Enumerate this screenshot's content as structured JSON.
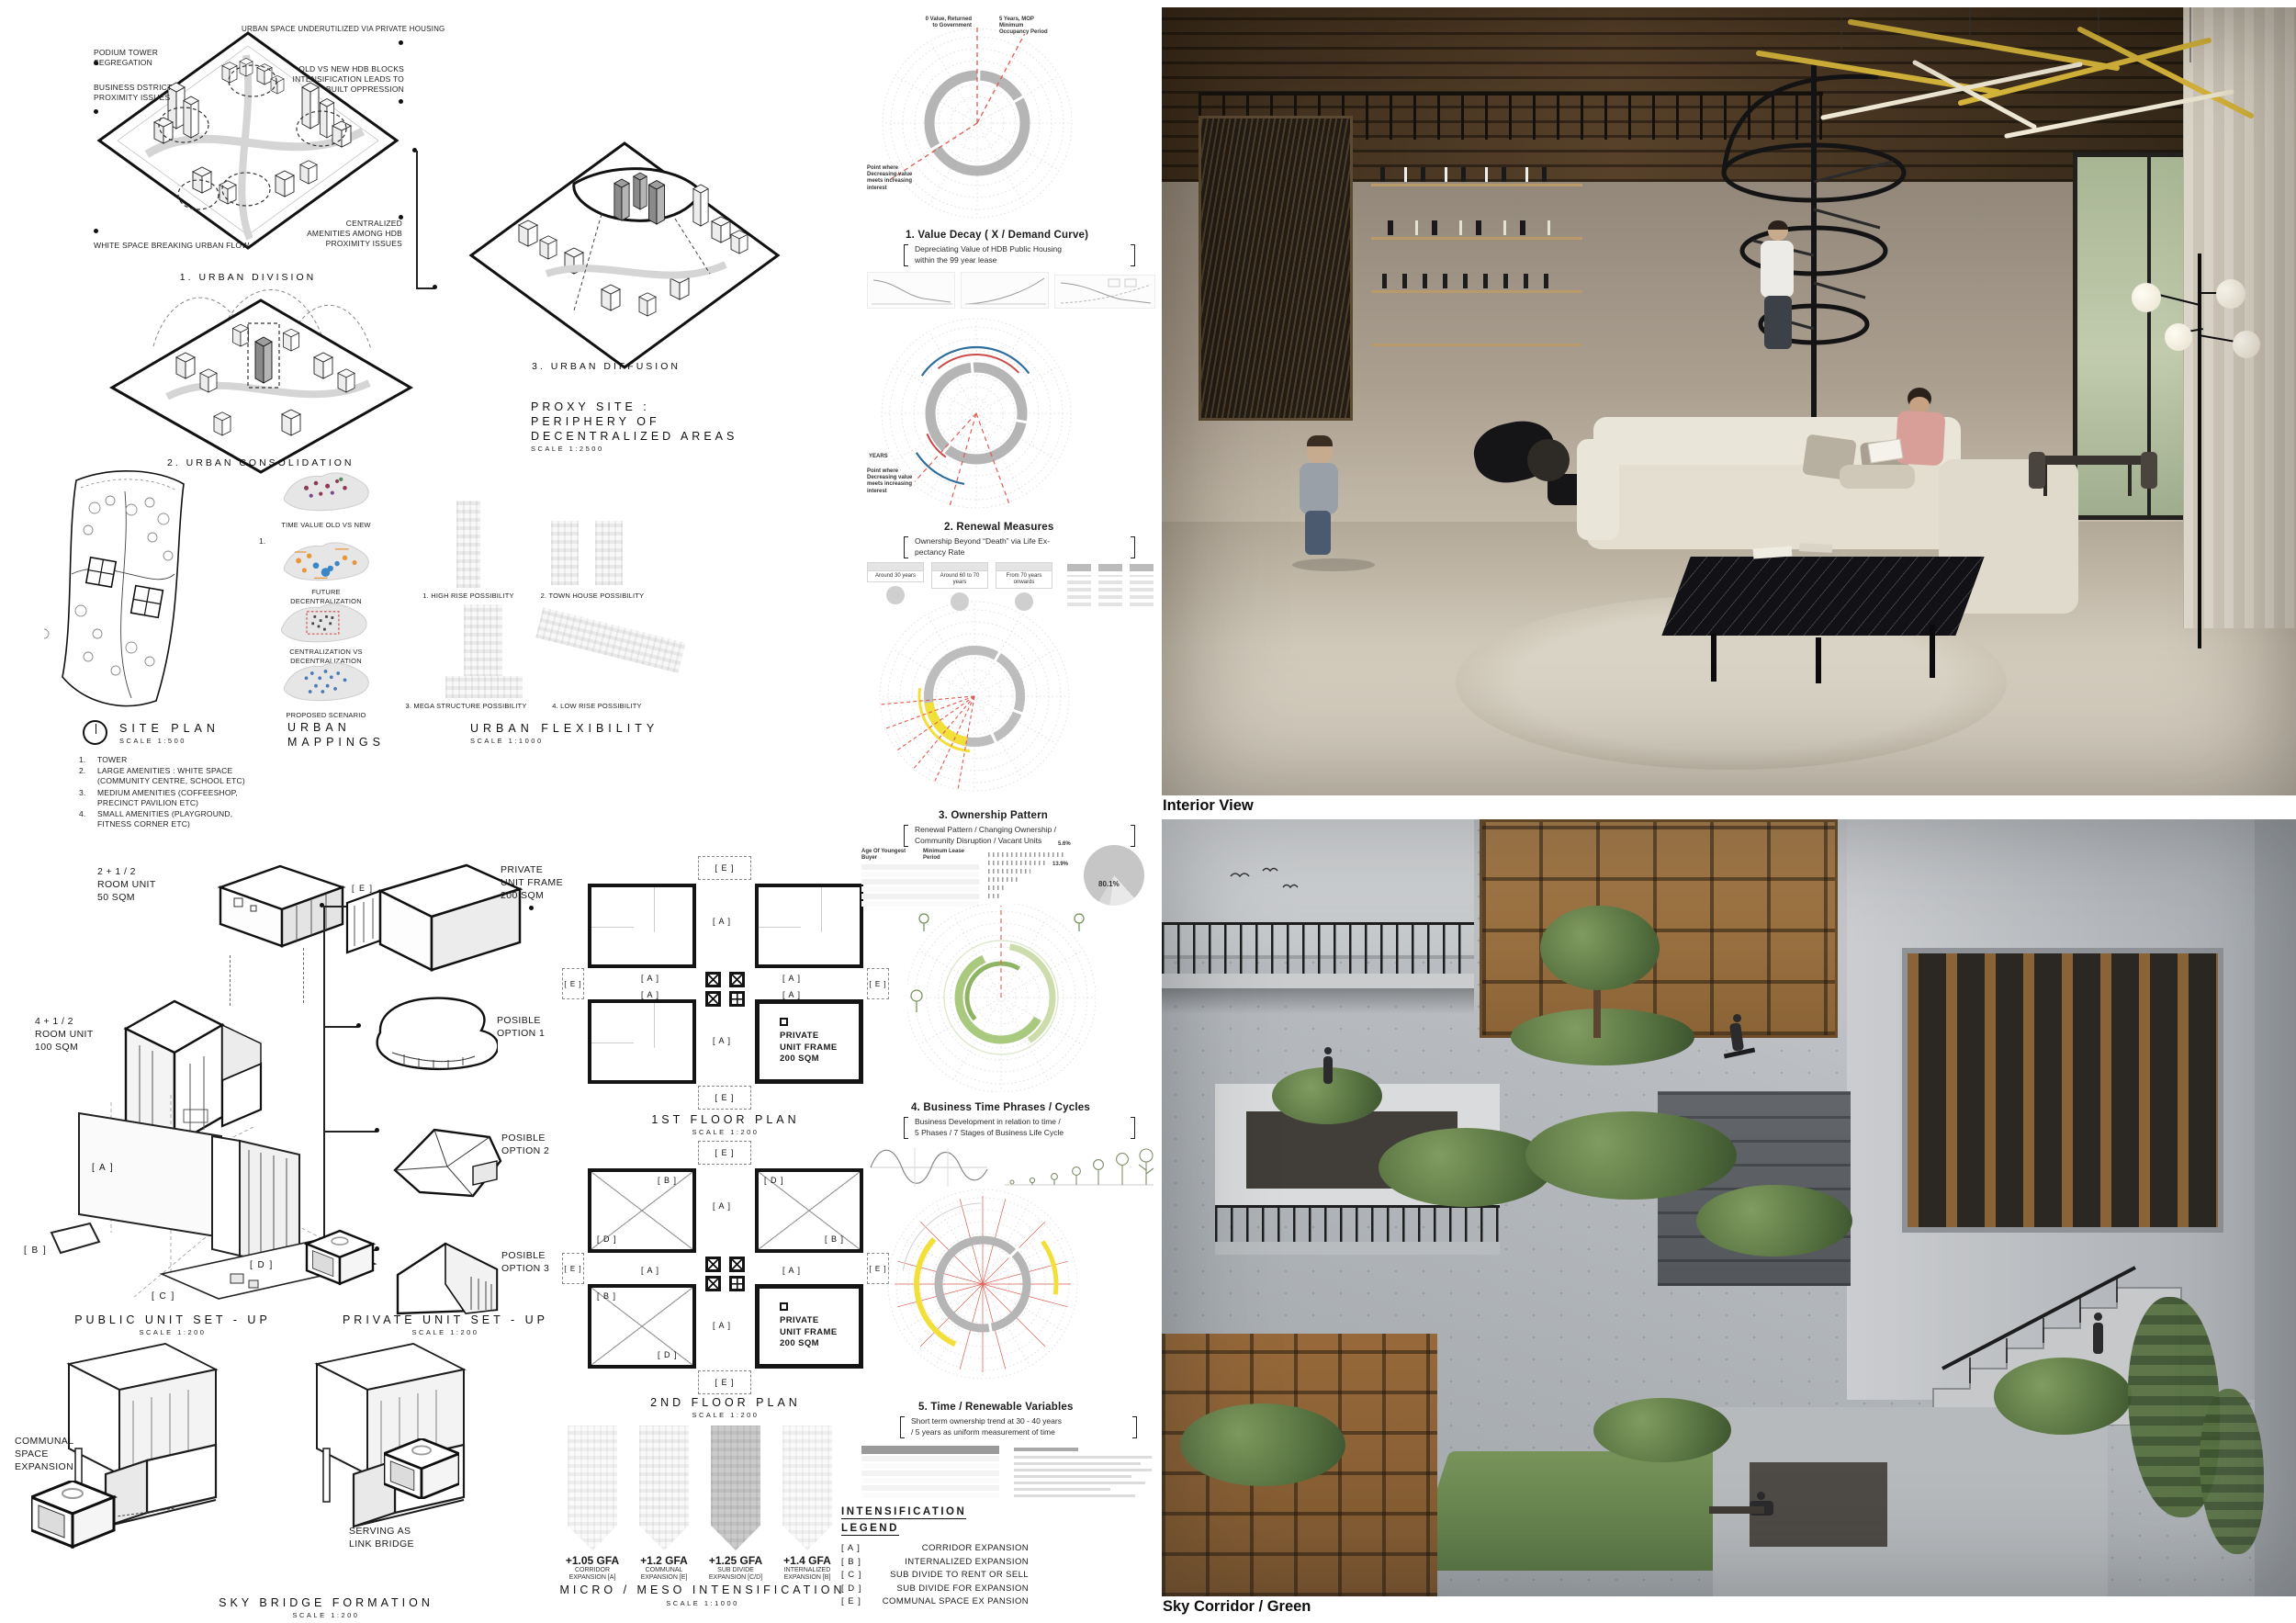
{
  "colors": {
    "ink": "#1a1a1a",
    "accent_red": "#e05b52",
    "accent_blue": "#2e6e9e",
    "accent_yellow": "#f3df3a",
    "accent_green": "#a9c97e",
    "ring_gray": "#b5b5b5"
  },
  "d1": {
    "label": "1. URBAN DIVISION",
    "c1": "URBAN SPACE UNDERUTILIZED VIA PRIVATE HOUSING",
    "c2": "PODIUM TOWER SEGREGATION",
    "c3": "BUSINESS DSTRICT PROXIMITY ISSUES",
    "c4": "OLD VS NEW HDB BLOCKS INTENSIFICATION LEADS TO BUILT OPPRESSION",
    "c5": "CENTRALIZED AMENITIES AMONG HDB PROXIMITY ISSUES",
    "c6": "WHITE SPACE BREAKING URBAN FLOW"
  },
  "d2": {
    "label": "2. URBAN CONSOLIDATION"
  },
  "d3": {
    "label": "3. URBAN DIFFUSION"
  },
  "proxy": {
    "l1": "PROXY SITE :",
    "l2": "PERIPHERY OF",
    "l3": "DECENTRALIZED AREAS",
    "scale": "SCALE 1:2500"
  },
  "site_plan": {
    "title": "SITE PLAN",
    "scale": "SCALE 1:500",
    "legend": [
      {
        "n": "1.",
        "t": "TOWER"
      },
      {
        "n": "2.",
        "t": "LARGE AMENITIES : WHITE SPACE (COMMUNITY CENTRE, SCHOOL ETC)"
      },
      {
        "n": "3.",
        "t": "MEDIUM AMENITIES (COFFEESHOP, PRECINCT PAVILION ETC)"
      },
      {
        "n": "4.",
        "t": "SMALL AMENITIES (PLAYGROUND, FITNESS CORNER ETC)"
      }
    ]
  },
  "mappings": {
    "t1": "URBAN",
    "t2": "MAPPINGS",
    "marker": "1.",
    "maps": [
      {
        "label": "TIME VALUE OLD VS NEW"
      },
      {
        "label": "FUTURE DECENTRALIZATION"
      },
      {
        "label": "CENTRALIZATION VS DECENTRALIZATION"
      },
      {
        "label": "PROPOSED SCENARIO"
      }
    ]
  },
  "flex": {
    "title": "URBAN FLEXIBILITY",
    "scale": "SCALE 1:1000",
    "o1": "1. HIGH RISE POSSIBILITY",
    "o2": "2. TOWN HOUSE POSSIBILITY",
    "o3": "3. MEGA STRUCTURE POSSIBILITY",
    "o4": "4. LOW RISE POSSIBILITY"
  },
  "units": {
    "small": {
      "l1": "2 + 1 / 2",
      "l2": "ROOM UNIT",
      "l3": "50 SQM"
    },
    "large": {
      "l1": "4 + 1 / 2",
      "l2": "ROOM UNIT",
      "l3": "100 SQM"
    },
    "frame": {
      "l1": "PRIVATE",
      "l2": "UNIT FRAME",
      "l3": "200 SQM"
    },
    "frame_tag": "[ E ]",
    "opt1a": "POSIBLE",
    "opt1b": "OPTION 1",
    "opt2a": "POSIBLE",
    "opt2b": "OPTION 2",
    "opt3a": "POSIBLE",
    "opt3b": "OPTION 3"
  },
  "setups": {
    "pub": "PUBLIC UNIT SET - UP",
    "priv": "PRIVATE UNIT SET - UP",
    "scale": "SCALE 1:200"
  },
  "tags": {
    "a": "[ A ]",
    "b": "[ B ]",
    "c": "[ C ]",
    "d": "[ D ]",
    "e": "[ E ]"
  },
  "plans": {
    "p1": "1ST FLOOR PLAN",
    "p2": "2ND FLOOR PLAN",
    "scale": "SCALE 1:200",
    "frame": {
      "l1": "PRIVATE",
      "l2": "UNIT FRAME",
      "l3": "200 SQM"
    }
  },
  "skybridge": {
    "title": "SKY BRIDGE FORMATION",
    "scale": "SCALE 1:200",
    "com1": "COMMUNAL",
    "com2": "SPACE",
    "com3": "EXPANSION",
    "link1": "SERVING AS",
    "link2": "LINK BRIDGE"
  },
  "micro": {
    "title": "MICRO / MESO INTENSIFICATION",
    "scale": "SCALE 1:1000",
    "towers": [
      {
        "gfa": "+1.05 GFA",
        "d1": "CORRIDOR",
        "d2": "EXPANSION [A]"
      },
      {
        "gfa": "+1.2 GFA",
        "d1": "COMMUNAL",
        "d2": "EXPANSION [E]"
      },
      {
        "gfa": "+1.25 GFA",
        "d1": "SUB DIVIDE",
        "d2": "EXPANSION [C/D]"
      },
      {
        "gfa": "+1.4 GFA",
        "d1": "INTERNALIZED",
        "d2": "EXPANSION [B]"
      }
    ]
  },
  "legend": {
    "t1": "INTENSIFICATION",
    "t2": "LEGEND",
    "entries": [
      {
        "k": "[ A ]",
        "v": "CORRIDOR EXPANSION"
      },
      {
        "k": "[ B ]",
        "v": "INTERNALIZED EXPANSION"
      },
      {
        "k": "[ C ]",
        "v": "SUB DIVIDE TO RENT OR SELL"
      },
      {
        "k": "[ D ]",
        "v": "SUB DIVIDE FOR EXPANSION"
      },
      {
        "k": "[ E ]",
        "v": "COMMUNAL SPACE EX PANSION"
      }
    ]
  },
  "analysis": {
    "s1": {
      "title": "1. Value Decay ( X / Demand Curve)",
      "sub1": "Depreciating Value of HDB Public Housing",
      "sub2": "within the 99 year lease",
      "ann_tl": "0 Value, Returned to Government",
      "ann_tr": "5 Years, MOP Minimum Occupancy Period",
      "ann_b": "Point where Decreasing value meets increasing interest"
    },
    "s2": {
      "title": "2. Renewal Measures",
      "sub1": "Ownership Beyond “Death” via Life Ex-",
      "sub2": "pectancy Rate",
      "axis": "YEARS",
      "ann_b": "Point where Decreasing value meets increasing interest",
      "cards": [
        "Around 30 years",
        "Around 60 to 70 years",
        "From 70 years onwards"
      ]
    },
    "s3": {
      "title": "3. Ownership Pattern",
      "sub1": "Renewal Pattern / Changing Ownership /",
      "sub2": "Community Disruption / Vacant Units",
      "th1": "Age Of Youngest Buyer",
      "th2": "Minimum Lease Period",
      "pie1": "80.1%",
      "pie2": "13.9%",
      "pie3": "5.6%"
    },
    "s4": {
      "title": "4. Business Time Phrases / Cycles",
      "sub1": "Business Development in relation to time /",
      "sub2": "5 Phases / 7 Stages of Business Life Cycle"
    },
    "s5": {
      "title": "5. Time / Renewable Variables",
      "sub1": "Short term ownership trend at 30 - 40 years",
      "sub2": "/ 5 years as uniform measurement of time"
    }
  },
  "renders": {
    "interior": "Interior View",
    "sky": "Sky Corridor / Green"
  }
}
